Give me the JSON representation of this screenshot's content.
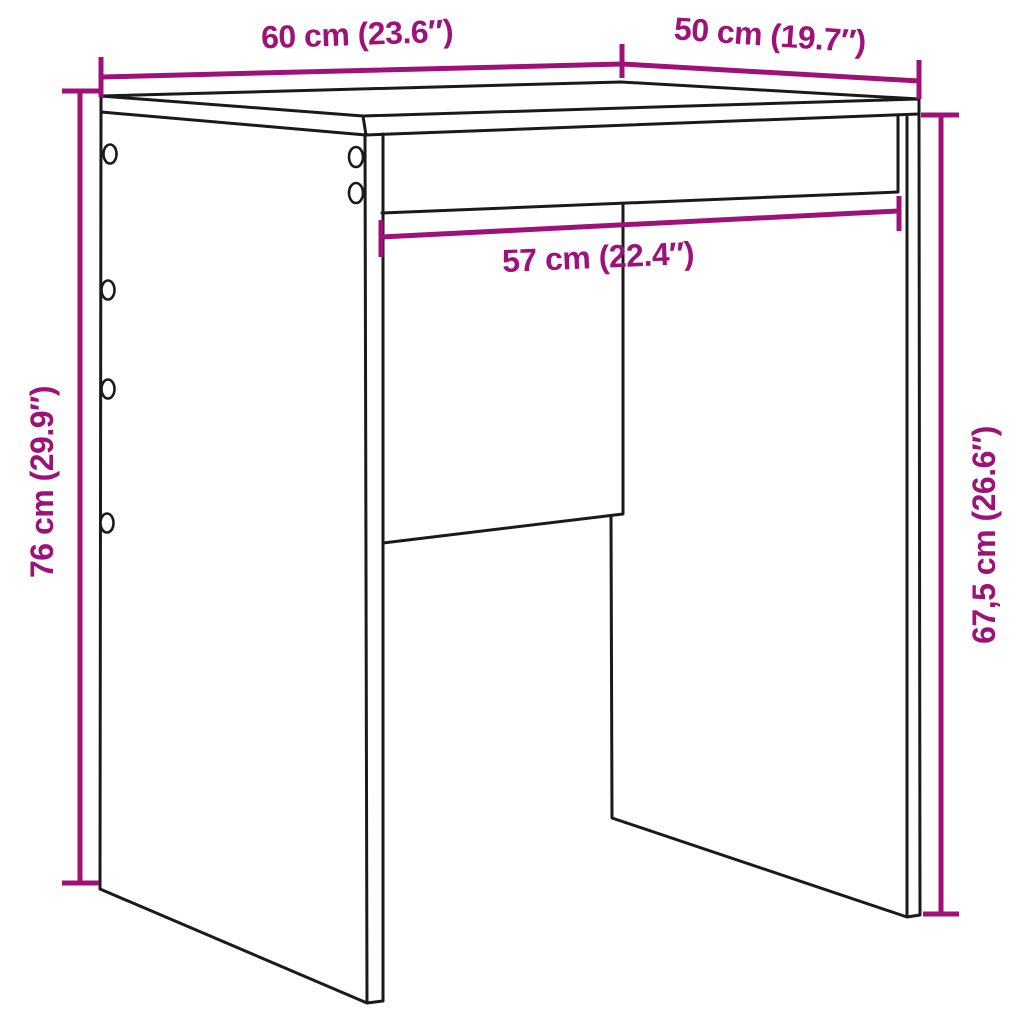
{
  "page": {
    "background": "#ffffff",
    "type": "product-dimension-diagram",
    "subject": "perspective line drawing of a stool / side table with seat, two side panels, back panel and front apron"
  },
  "colors": {
    "dimension": "#9E1178",
    "outline": "#1A1A1A"
  },
  "dimensions": [
    {
      "id": "top-width",
      "label": "60 cm (23.6″)",
      "cm": "60",
      "inches": "23.6"
    },
    {
      "id": "top-depth",
      "label": "50 cm (19.7″)",
      "cm": "50",
      "inches": "19.7"
    },
    {
      "id": "inner-width",
      "label": "57 cm (22.4″)",
      "cm": "57",
      "inches": "22.4"
    },
    {
      "id": "overall-height",
      "label": "76 cm (29.9″)",
      "cm": "76",
      "inches": "29.9"
    },
    {
      "id": "inner-height",
      "label": "67,5 cm (26.6″)",
      "cm": "67,5",
      "inches": "26.6"
    }
  ],
  "features": {
    "screw_holes_back_edge": 4,
    "screw_holes_front_edge": 2
  }
}
